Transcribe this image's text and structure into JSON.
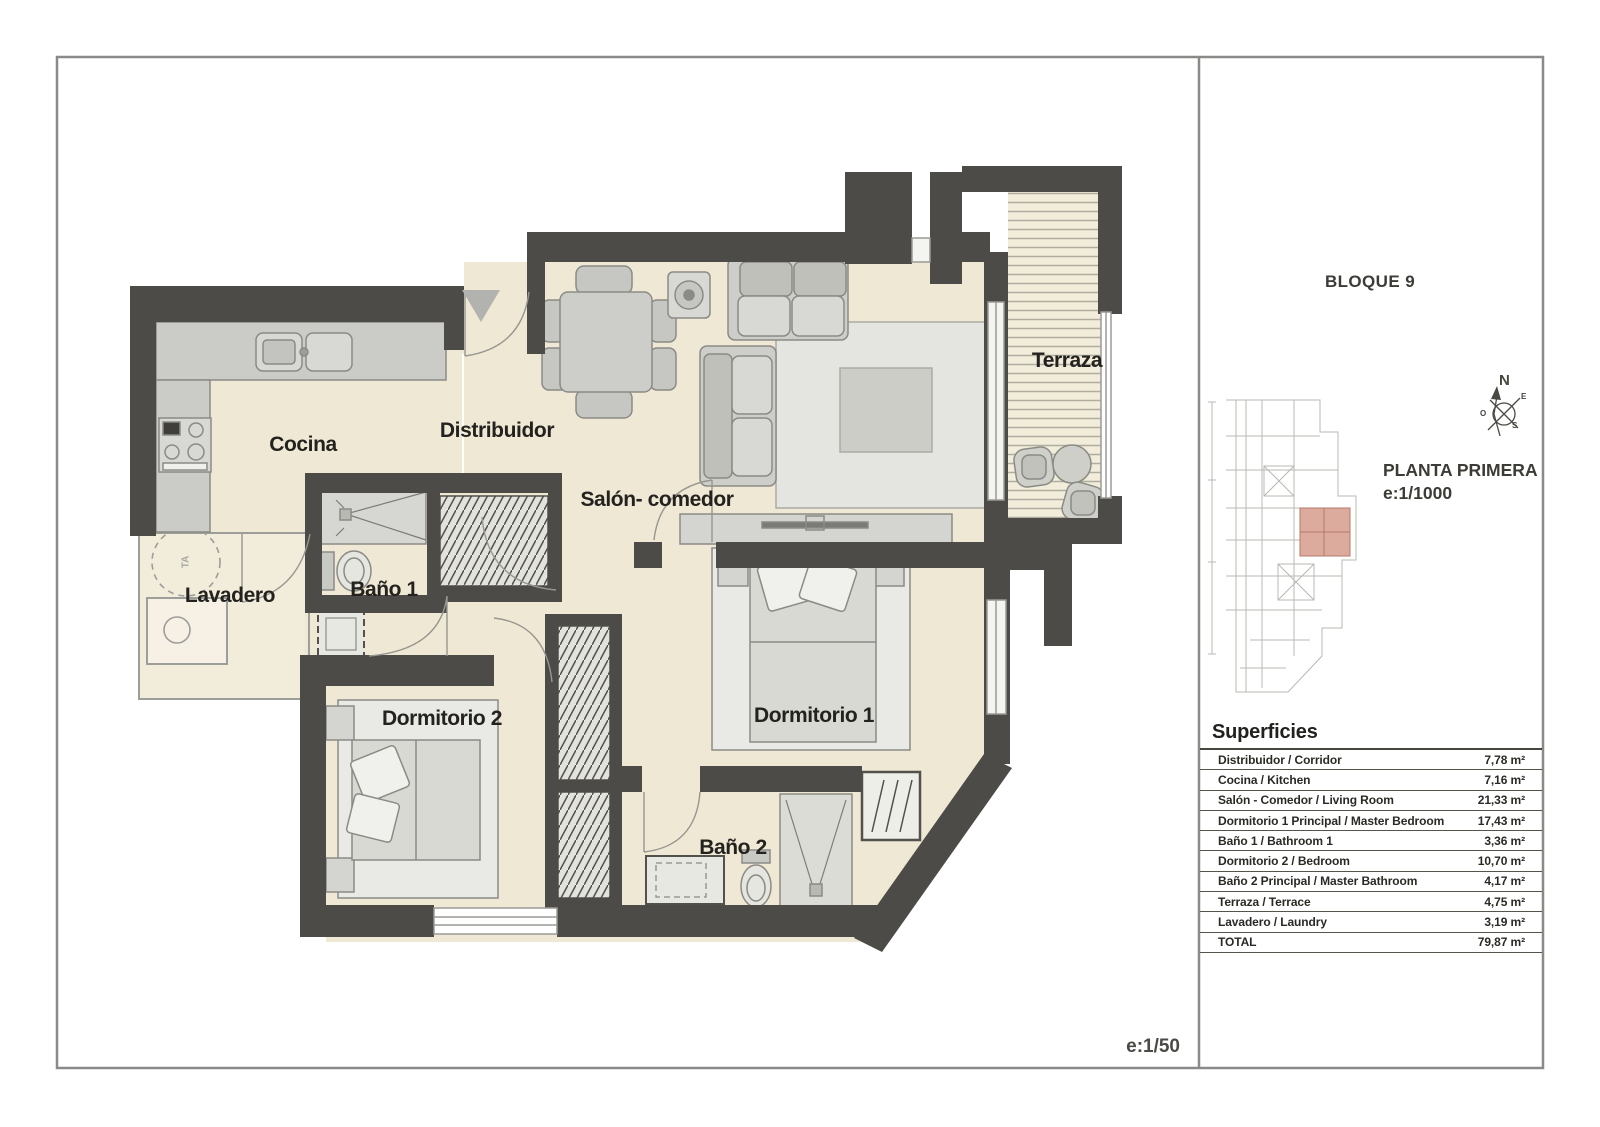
{
  "plan": {
    "rooms": [
      {
        "id": "cocina",
        "label": "Cocina"
      },
      {
        "id": "distribuidor",
        "label": "Distribuidor"
      },
      {
        "id": "salon",
        "label": "Salón- comedor"
      },
      {
        "id": "terraza",
        "label": "Terraza"
      },
      {
        "id": "lavadero",
        "label": "Lavadero"
      },
      {
        "id": "bano1",
        "label": "Baño 1"
      },
      {
        "id": "dormitorio2",
        "label": "Dormitorio 2"
      },
      {
        "id": "dormitorio1",
        "label": "Dormitorio 1"
      },
      {
        "id": "bano2",
        "label": "Baño 2"
      }
    ],
    "lavadero_tag": "TA",
    "scale_note": "e:1/50"
  },
  "panel": {
    "block_title": "BLOQUE 9",
    "plan_name": "PLANTA PRIMERA",
    "plan_scale": "e:1/1000",
    "compass": {
      "n": "N",
      "e": "E",
      "o": "O",
      "s": "S"
    },
    "surfaces": {
      "title": "Superficies",
      "rows": [
        {
          "label": "Distribuidor / Corridor",
          "value": "7,78 m²"
        },
        {
          "label": "Cocina / Kitchen",
          "value": "7,16 m²"
        },
        {
          "label": "Salón - Comedor / Living Room",
          "value": "21,33 m²"
        },
        {
          "label": "Dormitorio 1 Principal / Master Bedroom",
          "value": "17,43 m²"
        },
        {
          "label": "Baño 1 / Bathroom 1",
          "value": "3,36 m²"
        },
        {
          "label": "Dormitorio 2 / Bedroom",
          "value": "10,70 m²"
        },
        {
          "label": "Baño 2 Principal / Master Bathroom",
          "value": "4,17 m²"
        },
        {
          "label": "Terraza / Terrace",
          "value": "4,75 m²"
        },
        {
          "label": "Lavadero / Laundry",
          "value": "3,19 m²"
        },
        {
          "label": "TOTAL",
          "value": "79,87 m²"
        }
      ]
    }
  },
  "colors": {
    "wall": "#4c4b47",
    "floor": "#efe8d5",
    "highlight_unit": "#dcab9e"
  }
}
